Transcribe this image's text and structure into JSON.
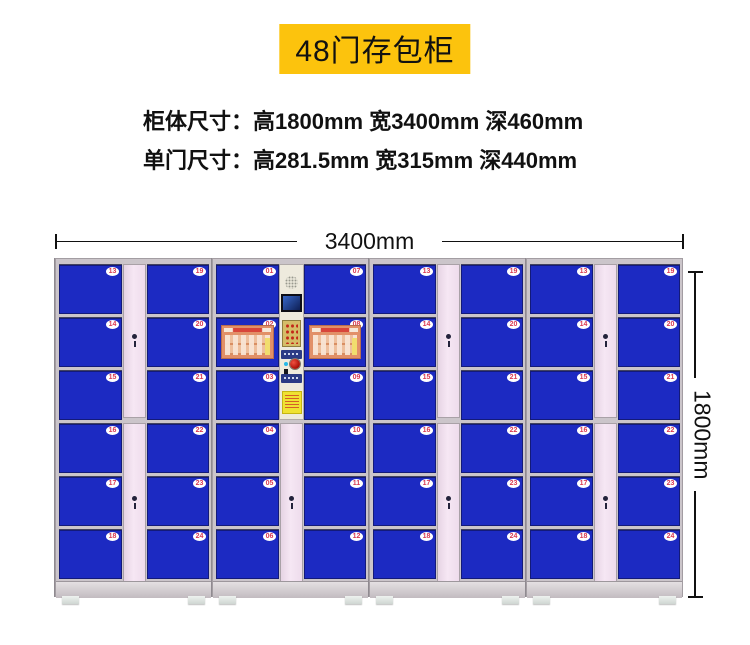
{
  "banner": {
    "title": "48门存包柜"
  },
  "specs": {
    "line1": {
      "label": "柜体尺寸：",
      "value": "高1800mm 宽3400mm 深460mm"
    },
    "line2": {
      "label": "单门尺寸：",
      "value": "高281.5mm 宽315mm 深440mm"
    }
  },
  "dimension_labels": {
    "width": "3400mm",
    "height": "1800mm"
  },
  "colors": {
    "banner_bg": "#fcc30d",
    "door_blue": "#1c2ac2",
    "panel_pink": "#f6e7f4",
    "control_cream": "#eeeadd",
    "badge_red": "#d93a52"
  },
  "locker": {
    "lock_icon": "key-lock",
    "units": [
      {
        "name": "unit-1",
        "type": "side",
        "left_doors": [
          "13",
          "14",
          "15",
          "16",
          "17",
          "18"
        ],
        "right_doors": [
          "19",
          "20",
          "21",
          "22",
          "23",
          "24"
        ]
      },
      {
        "name": "unit-2-main",
        "type": "main",
        "left_doors": [
          "01",
          "02",
          "03",
          "04",
          "05",
          "06"
        ],
        "right_doors": [
          "07",
          "08",
          "09",
          "10",
          "11",
          "12"
        ],
        "poster_doors": [
          "02",
          "08"
        ],
        "control_panel": {
          "parts": [
            "speaker-grille",
            "display-screen",
            "keypad",
            "card-reader-label",
            "indicator-led",
            "confirm-button",
            "ticket-slot",
            "brand-label",
            "warning-sticker"
          ]
        }
      },
      {
        "name": "unit-3",
        "type": "side",
        "left_doors": [
          "13",
          "14",
          "15",
          "16",
          "17",
          "18"
        ],
        "right_doors": [
          "19",
          "20",
          "21",
          "22",
          "23",
          "24"
        ]
      },
      {
        "name": "unit-4",
        "type": "side",
        "left_doors": [
          "13",
          "14",
          "15",
          "16",
          "17",
          "18"
        ],
        "right_doors": [
          "19",
          "20",
          "21",
          "22",
          "23",
          "24"
        ]
      }
    ]
  }
}
